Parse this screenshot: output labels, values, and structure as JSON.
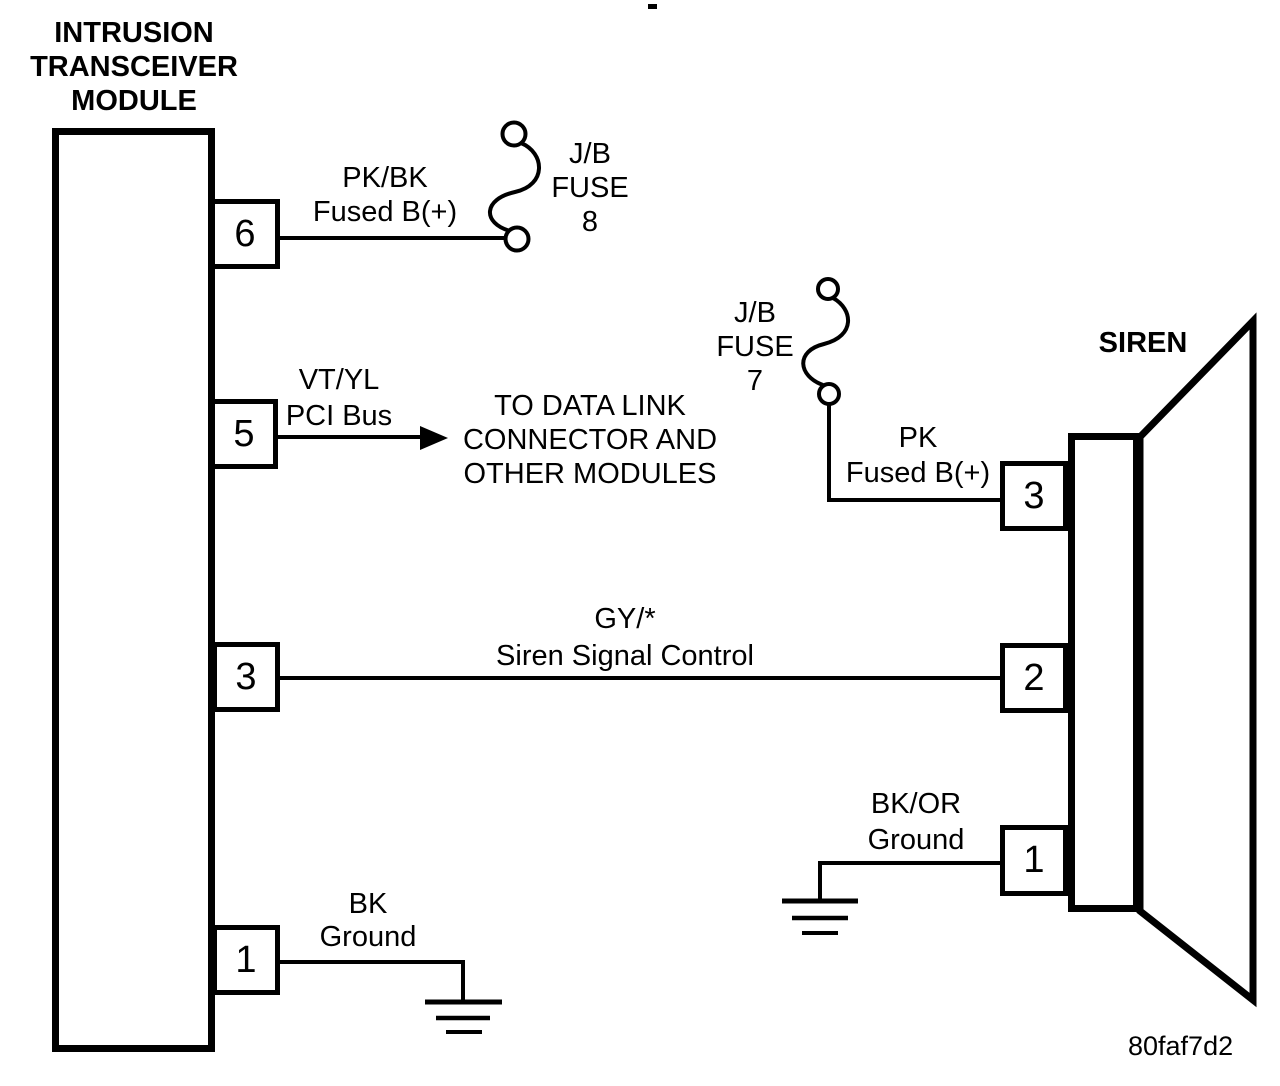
{
  "diagram": {
    "code": "80faf7d2",
    "module": {
      "title_lines": [
        "INTRUSION",
        "TRANSCEIVER",
        "MODULE"
      ],
      "pins": [
        "6",
        "5",
        "3",
        "1"
      ]
    },
    "siren": {
      "title": "SIREN",
      "pins": [
        "3",
        "2",
        "1"
      ]
    },
    "fuses": [
      {
        "location": "J/B",
        "type": "FUSE",
        "number": "8"
      },
      {
        "location": "J/B",
        "type": "FUSE",
        "number": "7"
      }
    ],
    "wires": [
      {
        "color": "PK/BK",
        "function": "Fused B(+)"
      },
      {
        "color": "VT/YL",
        "function": "PCI Bus"
      },
      {
        "color": "GY/*",
        "function": "Siren Signal Control"
      },
      {
        "color": "BK",
        "function": "Ground"
      },
      {
        "color": "PK",
        "function": "Fused B(+)"
      },
      {
        "color": "BK/OR",
        "function": "Ground"
      }
    ],
    "annotation_lines": [
      "TO DATA LINK",
      "CONNECTOR AND",
      "OTHER MODULES"
    ],
    "colors": {
      "ink": "#000000",
      "paper": "#ffffff"
    }
  }
}
